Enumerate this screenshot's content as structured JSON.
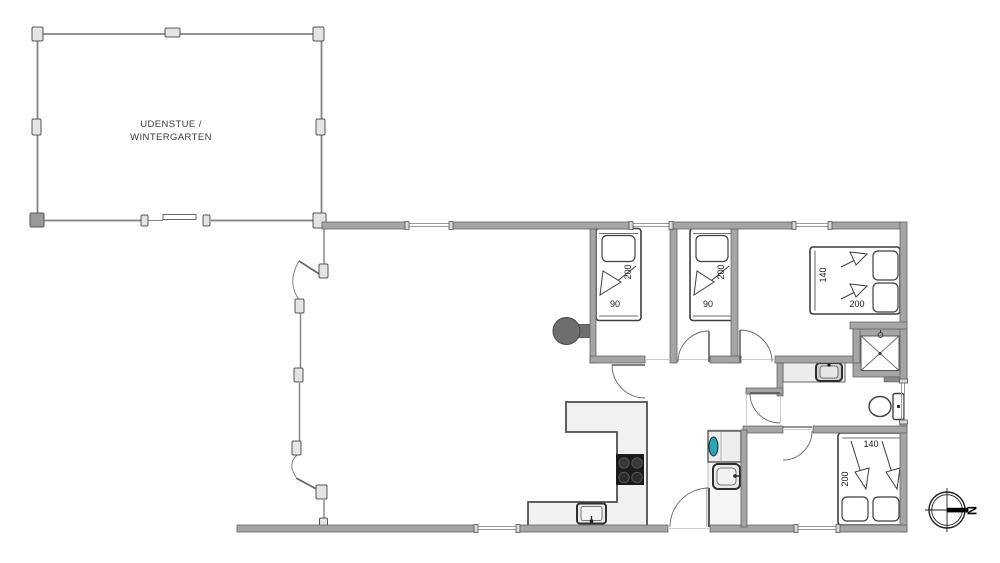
{
  "floor_plan": {
    "room_label": {
      "line1": "UDENSTUE /",
      "line2": "WINTERGARTEN"
    },
    "beds": [
      {
        "name": "single-bed-1",
        "length": "200",
        "width": "90"
      },
      {
        "name": "single-bed-2",
        "length": "200",
        "width": "90"
      },
      {
        "name": "double-bed-1",
        "width": "140",
        "length": "200"
      },
      {
        "name": "double-bed-2",
        "width": "140",
        "length": "200"
      }
    ],
    "compass": {
      "north_label": "N"
    },
    "colors": {
      "wall": "#a5a5a5",
      "wall_edge": "#5f5f5f",
      "counter": "#f1f1f1",
      "cooktop": "#1b1b1b",
      "wood_stove": "#6e6e6e",
      "appliance_accent": "#2da4b4",
      "door_arc": "#666666",
      "text": "#1a1a1a"
    }
  }
}
